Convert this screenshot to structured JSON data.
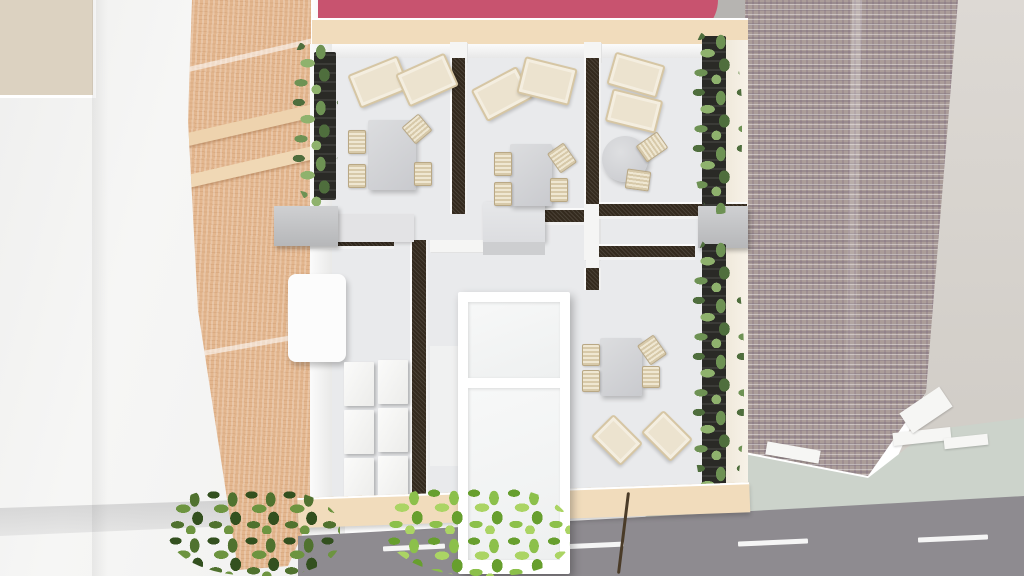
{
  "scene": {
    "title": "Top-down 3D architectural render of a furnished cafe floor plan",
    "view": "bird's-eye 3D render, no visible text or UI controls",
    "surroundings": [
      "white neighbor rooftops (left)",
      "terracotta tiled roof (left of building)",
      "pink flat roof (top)",
      "herringbone brick roof (right)",
      "sidewalk and road with dashed lane markings (bottom)"
    ]
  },
  "colors": {
    "pink_roof": "#c8536f",
    "terracotta_roof": "#e3b68e",
    "sand_wall": "#f1dcbc",
    "floor": "#e9eaec",
    "interior_wall_dark": "#342a1e",
    "brick_roof": "#ab9d99",
    "right_wall": "#d8d5cf",
    "sidewalk": "#ccd3cb",
    "road": "#8e8b90",
    "lane_marking": "#f5f5f5",
    "neighbor_roof": "#f2f2f1",
    "beige_patch": "#dcd2c1",
    "furniture_gray": "#d4d5d7",
    "chair_beige": "#e8dec8",
    "lounge_cream": "#ece3cf",
    "hedge_green": "#6f9457",
    "tree_green": "#8cc04b",
    "atrium_white": "#ffffff"
  },
  "rooms": [
    {
      "id": "lounge-room-left",
      "furniture": [
        "2 deck lounge chairs",
        "rectangular table",
        "4 slatted chairs",
        "wall planter hedge"
      ]
    },
    {
      "id": "lounge-room-middle",
      "furniture": [
        "2 deck lounge chairs",
        "rectangular table",
        "4 slatted chairs",
        "service counter"
      ]
    },
    {
      "id": "lounge-room-right",
      "furniture": [
        "2 deck lounge chairs",
        "round table",
        "2 slatted chairs",
        "wall planter hedge"
      ]
    },
    {
      "id": "storage-room-southwest",
      "furniture": [
        "white cabinet",
        "2x3 shelving unit",
        "gray corner boxes"
      ]
    },
    {
      "id": "dining-room-south",
      "furniture": [
        "rectangular table",
        "4 slatted chairs",
        "2 rotated lounge seats",
        "wall planter hedge"
      ]
    },
    {
      "id": "central-atrium",
      "furniture": [
        "white framed glass atrium / entrance corridor running to the street"
      ]
    }
  ],
  "road": {
    "lane_dash_count": 4,
    "sidewalk_slabs": 4
  },
  "vegetation": {
    "wall_hedges": 3,
    "street_trees": 2
  }
}
